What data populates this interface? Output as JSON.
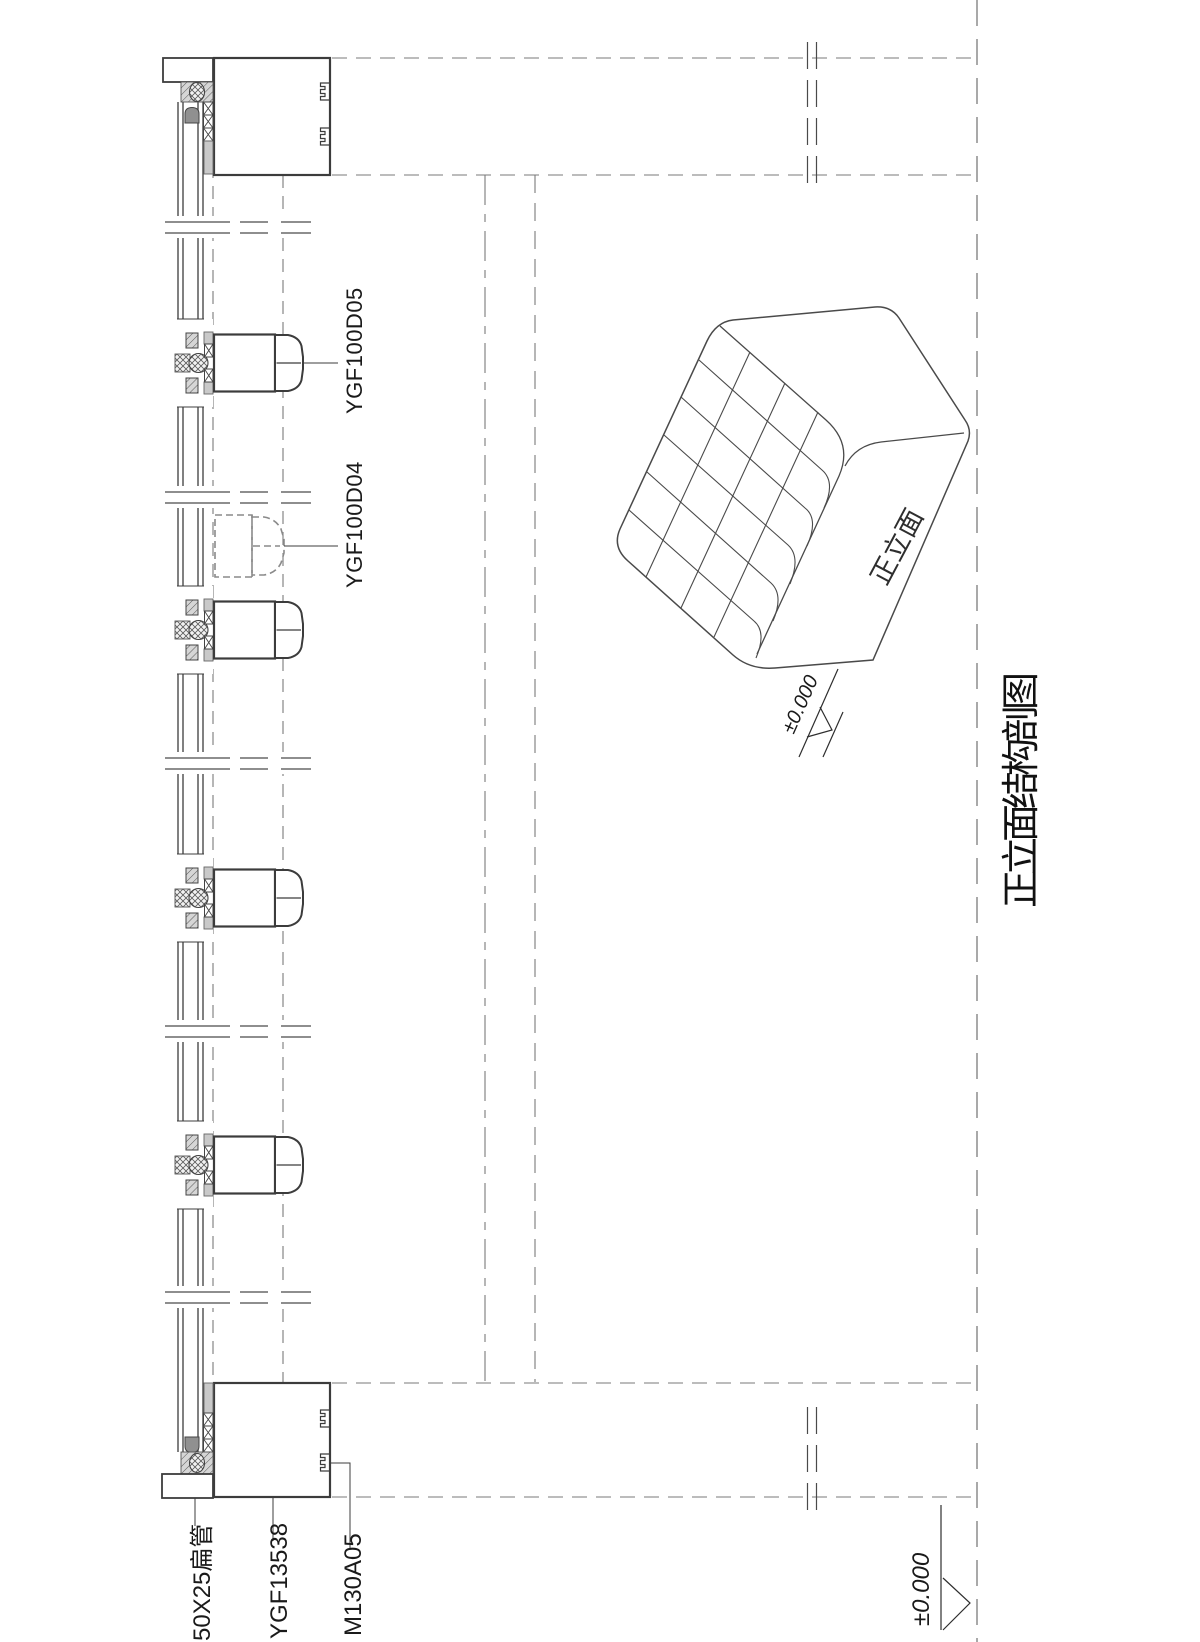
{
  "title": "正立面结构剖图",
  "labels": {
    "mullion_cap_outer": "YGF100D05",
    "mullion_cap_hidden": "YGF100D04",
    "flat_tube": "50X25扁管",
    "end_profile": "YGF13538",
    "pressure_clip": "M130A05"
  },
  "axonometric": {
    "front_face": "正立面",
    "level": "±0.000"
  },
  "base_level": "±0.000",
  "colors": {
    "background": "#ffffff",
    "line": "#3c3c3c",
    "dashed_line": "#7a7a7a",
    "grey_fill": "#c9c9c9",
    "dark_fill": "#8f8f8f"
  }
}
